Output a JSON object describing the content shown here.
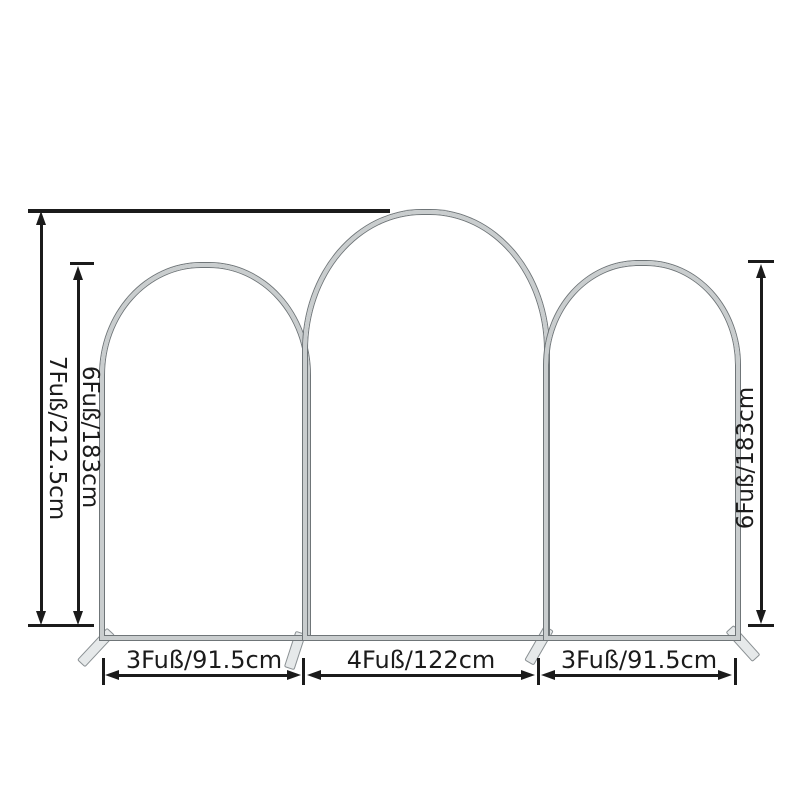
{
  "measurements": {
    "total_height": "7Fuß/212.5cm",
    "left_arch_height": "6Fuß/183cm",
    "right_arch_height": "6Fuß/183cm",
    "left_base_width": "3Fuß/91.5cm",
    "middle_base_width": "4Fuß/122cm",
    "right_base_width": "3Fuß/91.5cm"
  },
  "colors": {
    "dimension_lines": "#1b1b1b",
    "tube_fill": "#c9cdce",
    "tube_edge": "#6f7578",
    "foot_fill": "#e6e9ea",
    "background": "#ffffff"
  }
}
